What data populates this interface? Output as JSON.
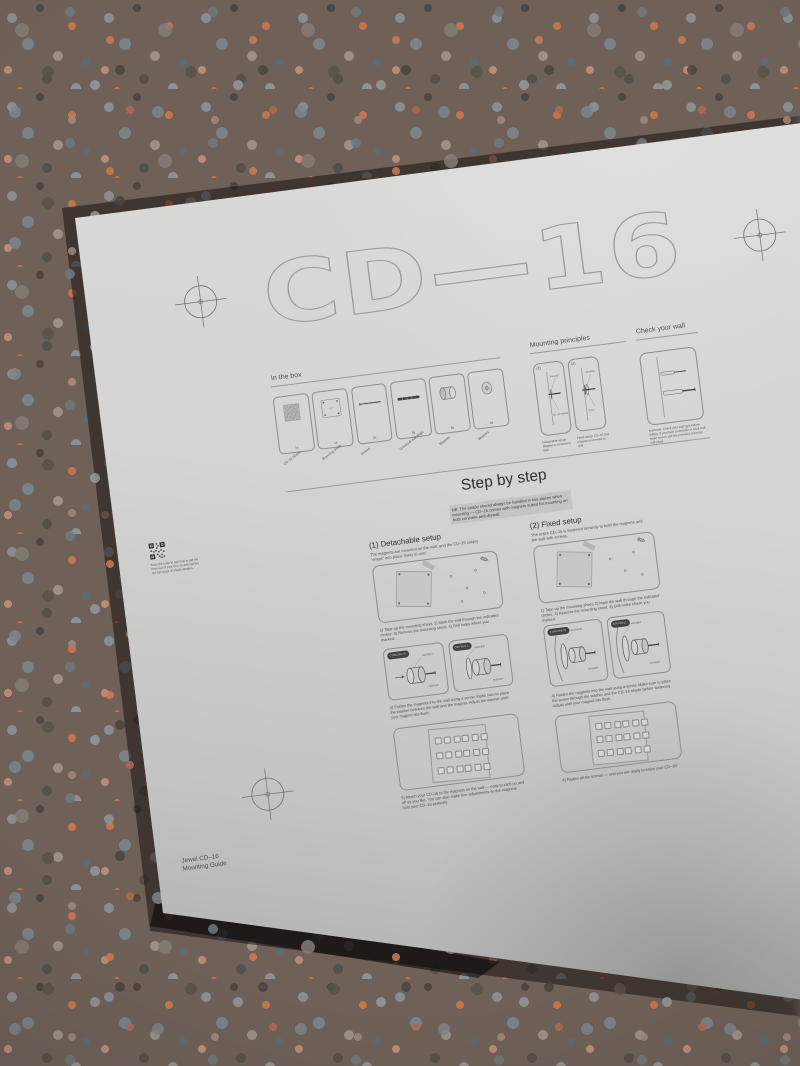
{
  "logo": "CD—16",
  "icons": {
    "pencil": "✎"
  },
  "in_the_box": {
    "title": "In the box",
    "items": [
      {
        "qty": "1x",
        "label": "CD–16 Shade"
      },
      {
        "qty": "1x",
        "label": "Mounting Guide"
      },
      {
        "qty": "8x",
        "label": "Screws"
      },
      {
        "qty": "8x",
        "label": "Universal wall plugs"
      },
      {
        "qty": "8x",
        "label": "Magnets"
      },
      {
        "qty": "8x",
        "label": "Washers"
      }
    ]
  },
  "mounting_principles": {
    "title": "Mounting principles",
    "labels": {
      "magnet": "MAGNET",
      "shade": "CD–16 SHADE",
      "wall": "WALL"
    },
    "options": [
      {
        "num": "(1)",
        "caption": "Detachable setup: Magnet is screwed to wall"
      },
      {
        "num": "(2)",
        "caption": "Fixed setup: CD–16 and magnet is screwed to wall"
      }
    ]
  },
  "check_your_wall": {
    "title": "Check your wall",
    "caption": "Important: Check your wall type before drilling. If you have a concrete or brick wall, make sure to use the provided universal wall plugs."
  },
  "step_by_step": {
    "title": "Step by step",
    "note": "NB: The shade should always be handled in two places when mounting — CD–16 comes with magnets suited for mounting on both concrete and drywall."
  },
  "detachable": {
    "title": "(1) Detachable setup",
    "intro": "The magnets are mounted on the wall, and the CD–16 simply “snaps” into place. Easy to use!",
    "step1": "1) Tape up the mounting sheet. 2) Mark the wall through the indicated circles. 3) Remove the mounting sheet. 4) Drill holes where you marked.",
    "badge_left": "CONCRETE",
    "badge_right": "DRYWALL",
    "labels": {
      "magnet": "MAGNET",
      "washer": "WASHER",
      "screw": "SCREW"
    },
    "step2": "4) Fasten the magnets into the wall using a screw. Make sure to place the washer between the wall and the magnet. Adjust the washer until your magnet sits flush.",
    "step3": "5) Attach your CD–16 to the magnets on the wall — easy to click on and off as you like. You can also make fine adjustments so the magnets hold your CD–16 perfectly."
  },
  "fixed": {
    "title": "(2) Fixed setup",
    "intro": "The entire CD–16 is fastened securely to both the magnets and the wall with screws.",
    "step1": "1) Tape up the mounting sheet. 2) Mark the wall through the indicated circles. 3) Remove the mounting sheet. 4) Drill holes where you marked.",
    "badge_left": "CONCRETE",
    "badge_right": "DRYWALL",
    "labels": {
      "magnet": "MAGNET",
      "washer": "WASHER",
      "shade": "CD–16 SHADE"
    },
    "step2": "4) Fasten the magnets into the wall using a screw. Make sure to place the screw through the washer and the CD–16 shade before fastening. Adjust until your magnet sits flush.",
    "step3": "4) Fasten all the screws — and you are ready to enjoy your CD–16!"
  },
  "qr": {
    "note": "Scan the code to see how to get the most out of your CD–16 and explore our full range of shade designs."
  },
  "footer": {
    "line1": "Jewel CD–16",
    "line2": "Mounting Guide"
  }
}
